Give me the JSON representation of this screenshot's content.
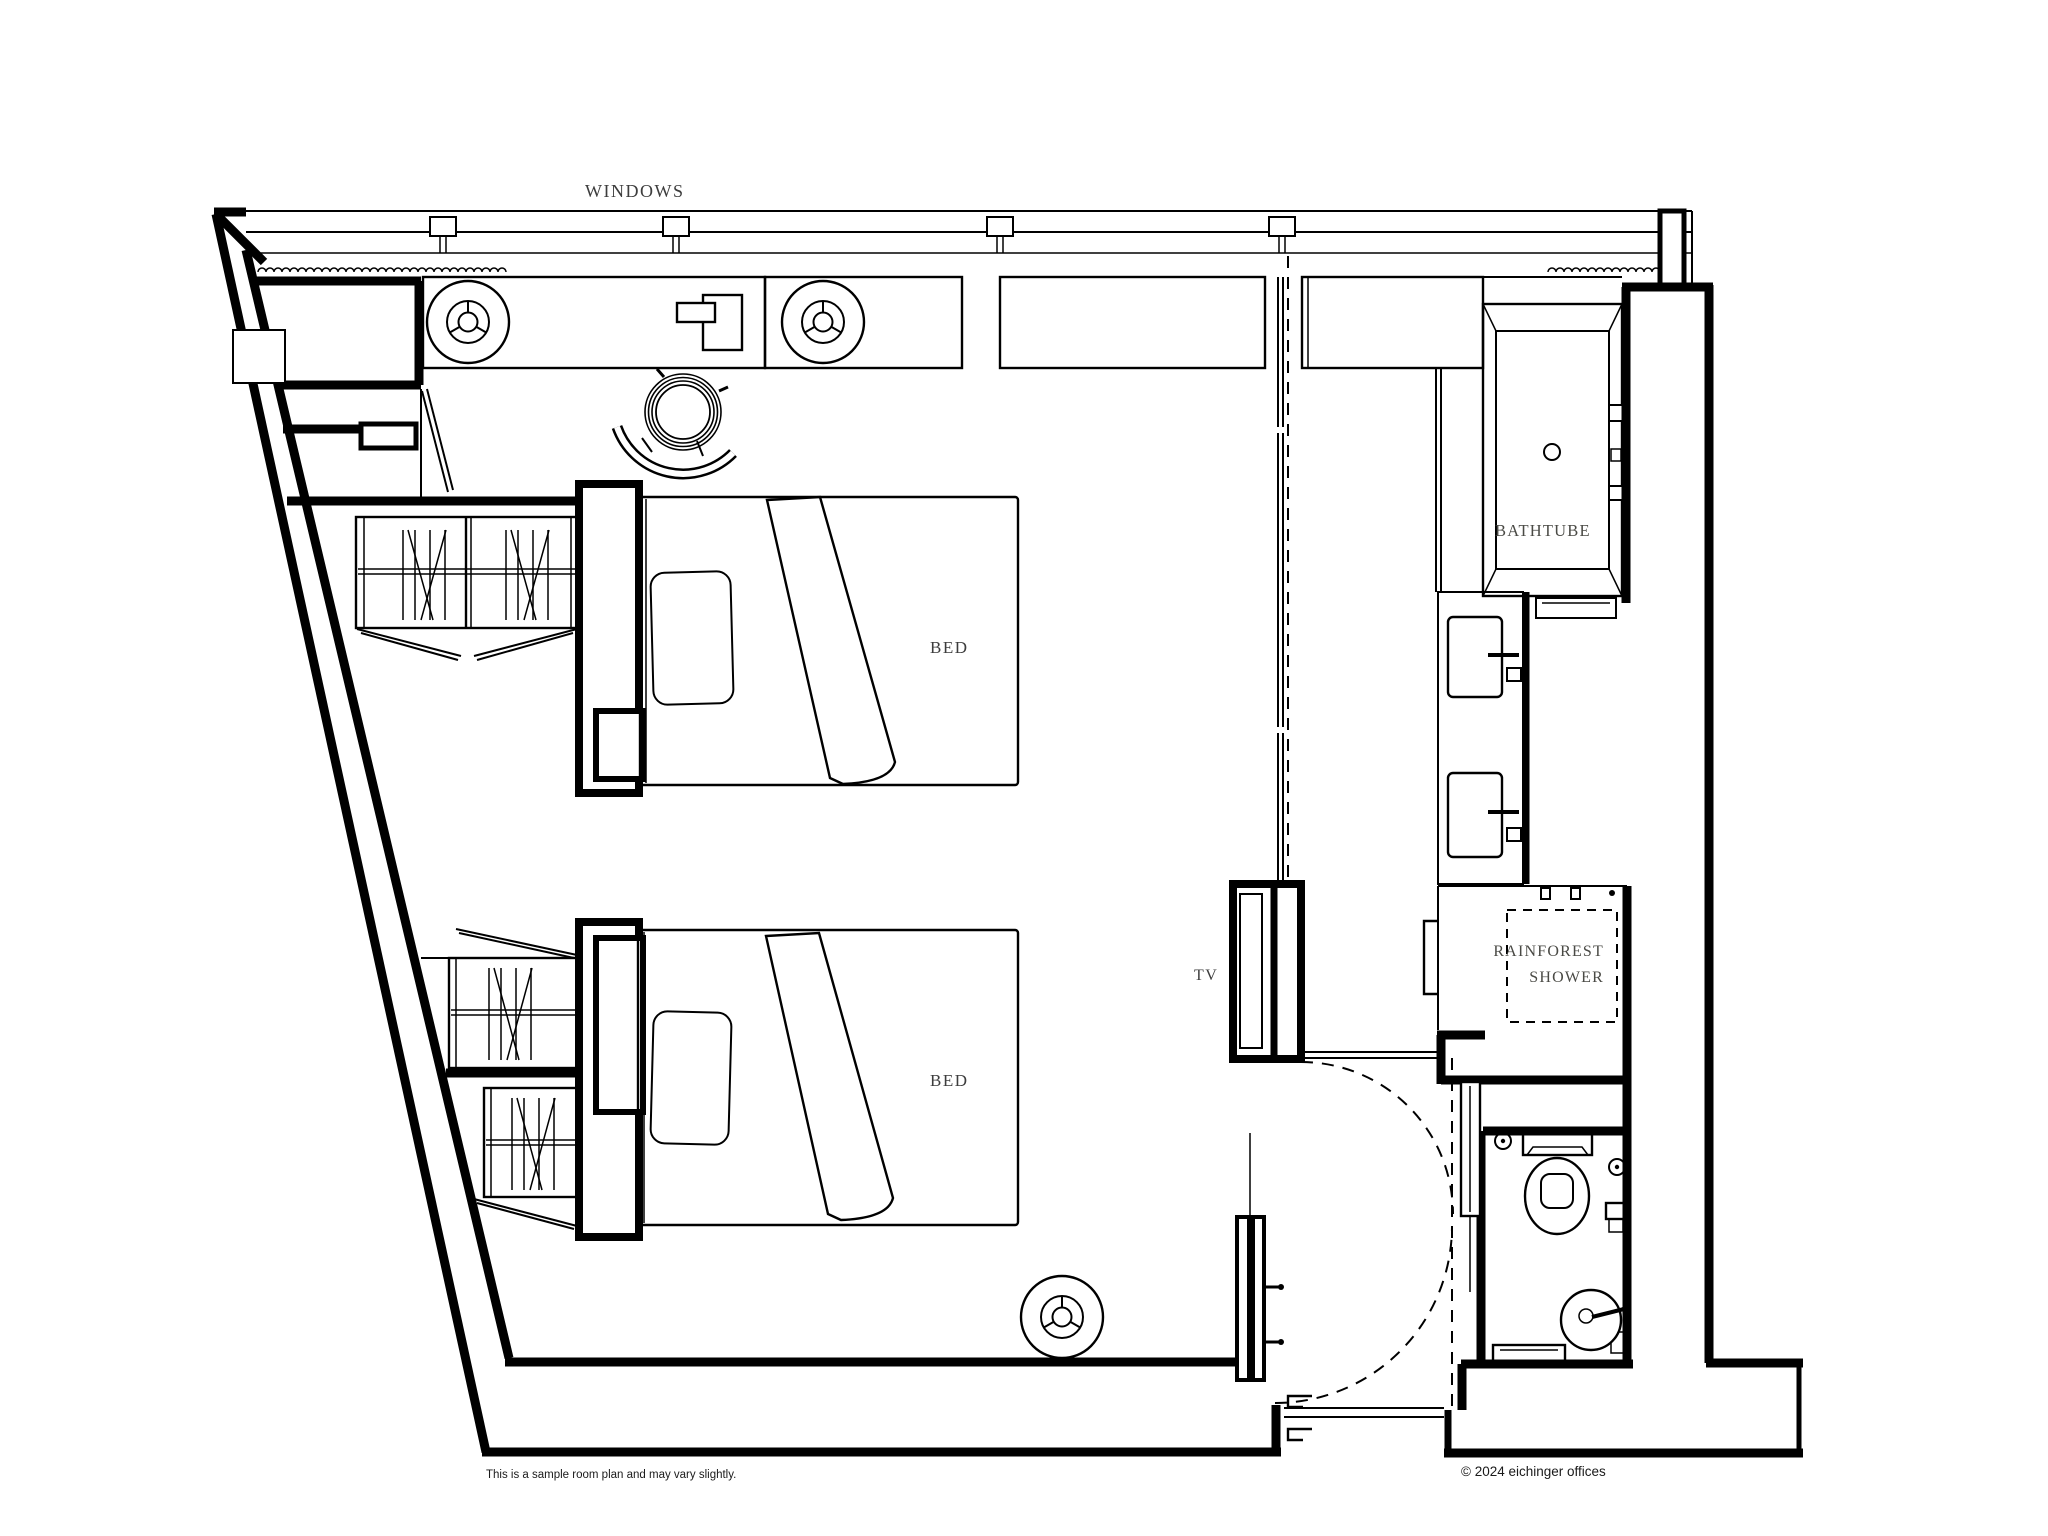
{
  "plan": {
    "labels": {
      "windows": "WINDOWS",
      "bed_upper": "BED",
      "bed_lower": "BED",
      "bathtub": "BATHTUBE",
      "tv": "TV",
      "shower_line1": "RAINFOREST",
      "shower_line2": "SHOWER"
    },
    "footer": {
      "note": "This is a sample room plan and may vary slightly.",
      "copyright": "© 2024 eichinger offices"
    },
    "colors": {
      "line": "#000000",
      "label": "#3d3d3d",
      "background": "#ffffff"
    }
  }
}
